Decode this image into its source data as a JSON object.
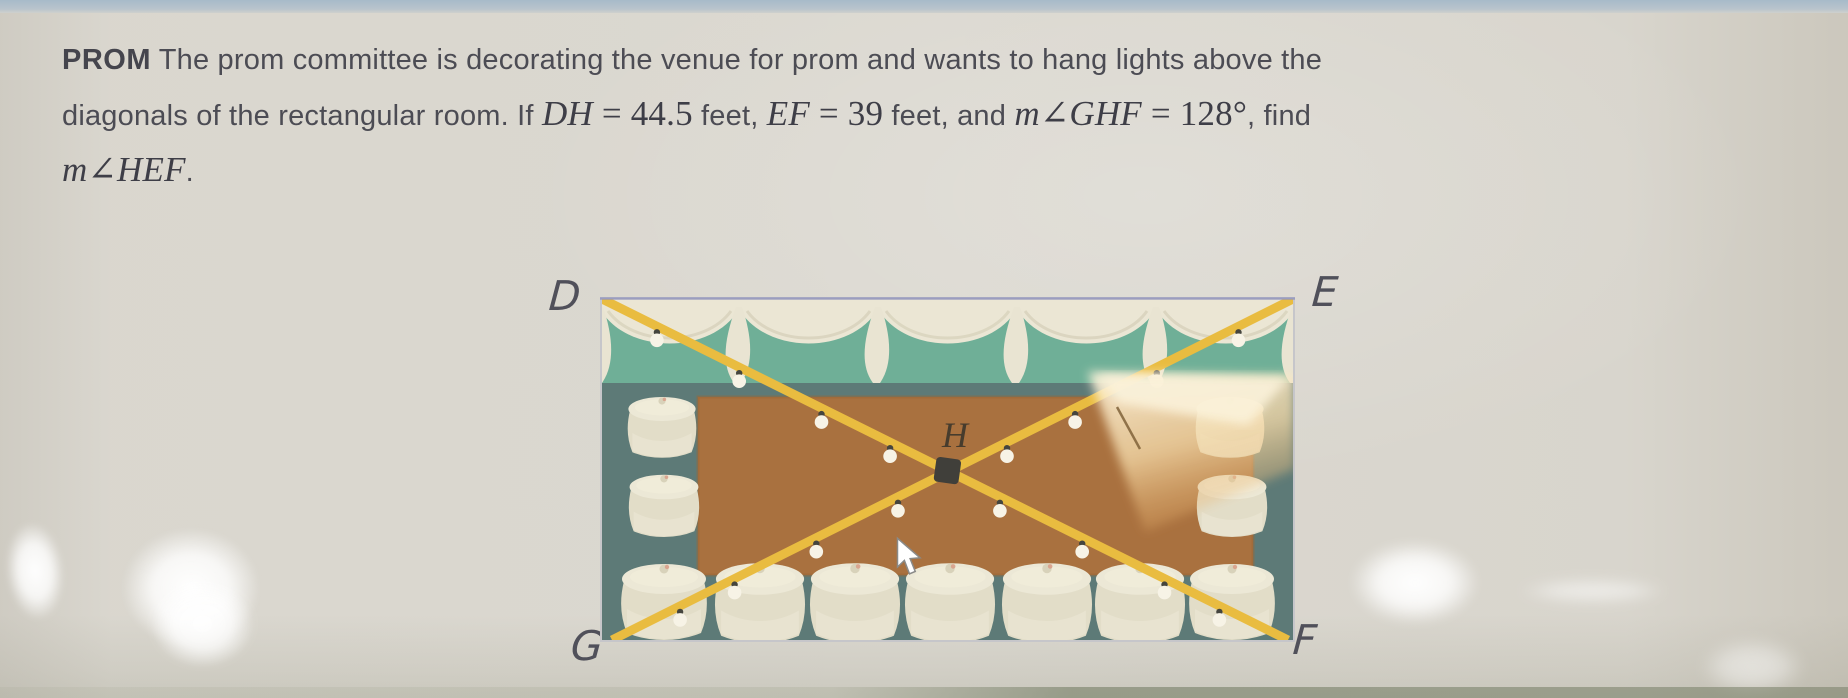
{
  "problem": {
    "bold": "PROM",
    "l1": " The prom committee is decorating the venue for prom and wants to hang lights above the",
    "l2a": "diagonals of the rectangular room. If ",
    "dh_var": "DH",
    "dh_eq": " = 44.5",
    "l2b": " feet, ",
    "ef_var": "EF",
    "ef_eq": " = 39",
    "l2c": " feet, and ",
    "m1": "m",
    "ang1": "∠",
    "ghf_var": "GHF",
    "ghf_eq": " = 128°",
    "l2d": ", find",
    "m2": "m",
    "ang2": "∠",
    "hef_var": "HEF",
    "period": "."
  },
  "given": {
    "DH_feet": 44.5,
    "EF_feet": 39,
    "angle_GHF_degrees": 128,
    "find": "m∠HEF"
  },
  "diagram": {
    "corner_labels": {
      "top_left": "D",
      "top_right": "E",
      "bottom_left": "G",
      "bottom_right": "F"
    },
    "center_label": "H",
    "colors": {
      "page_bg": "#dbd8d0",
      "top_strip": "#aebfce",
      "text": "#4c4c54",
      "wall": "#6faf97",
      "curtain": "#ebe6d4",
      "floor_border": "#5d7a77",
      "dance_floor": "#a9713f",
      "string_lights": "#e9bc40",
      "bulb": "#f7f3e6",
      "tablecloth": "#e9e4d1",
      "frame_border": "#c6c6ca"
    }
  }
}
